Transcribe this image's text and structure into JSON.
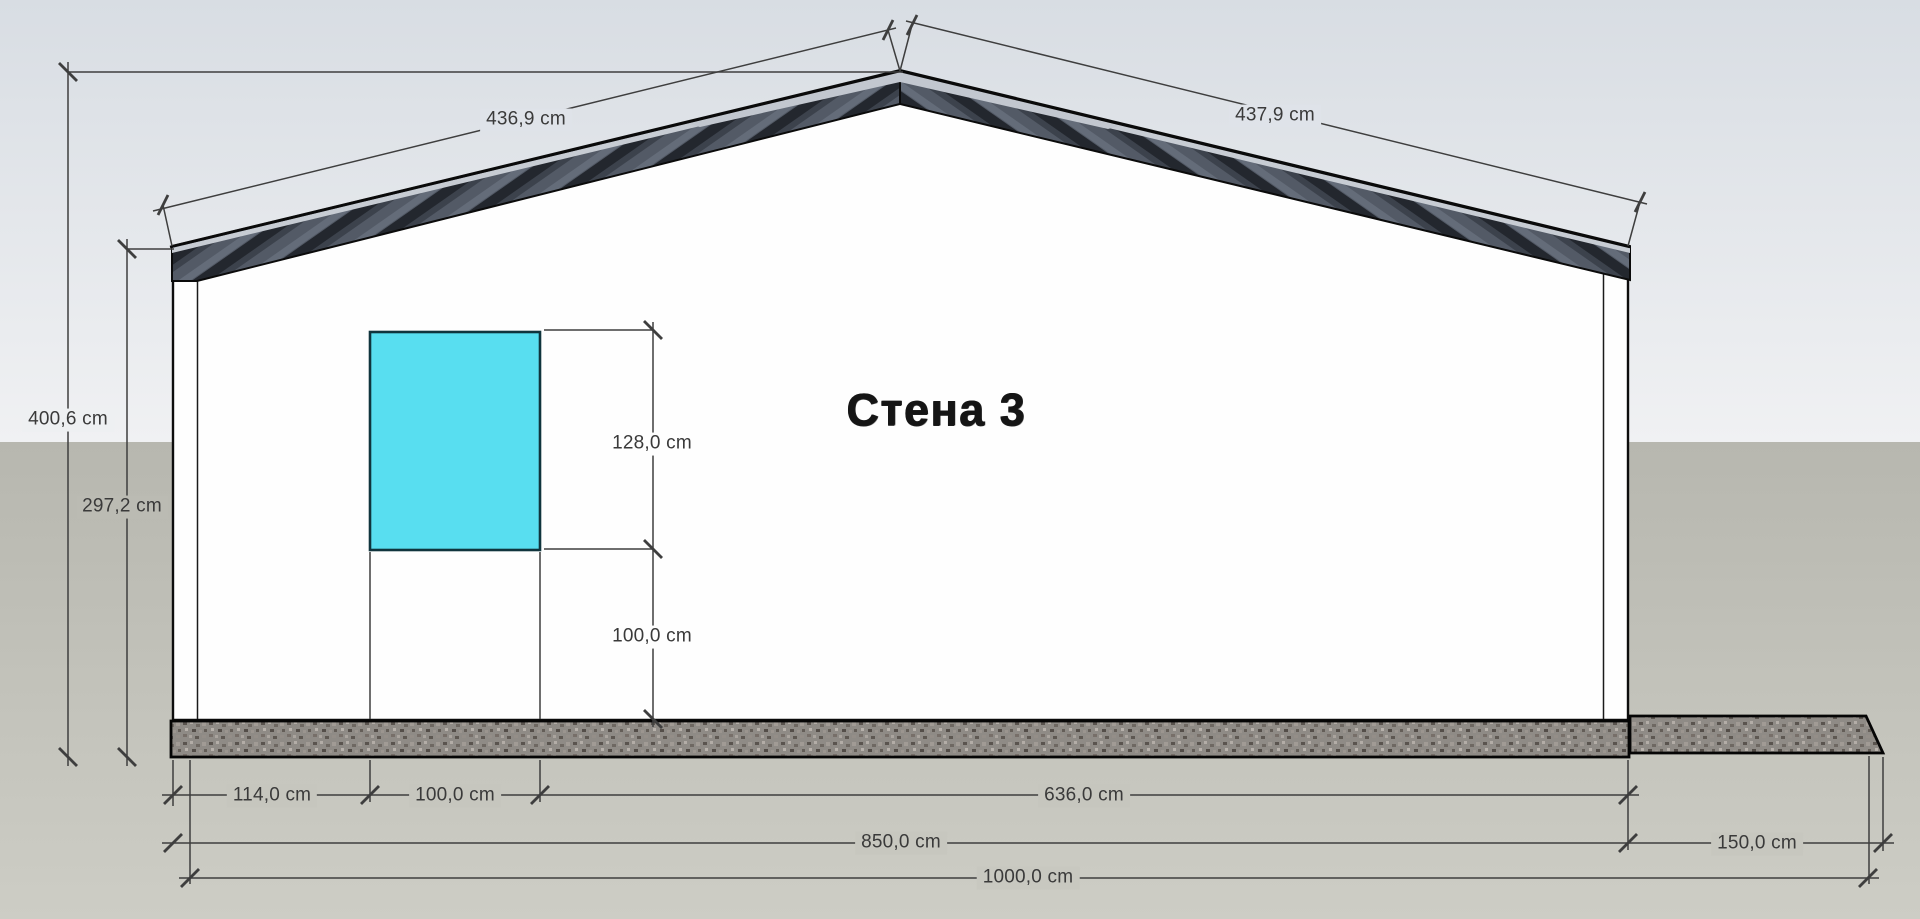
{
  "view": {
    "wall_label": "Стена 3",
    "unit": "cm"
  },
  "dims": {
    "roof_left": "436,9 cm",
    "roof_right": "437,9 cm",
    "total_height": "400,6 cm",
    "eave_height": "297,2 cm",
    "window_height": "128,0 cm",
    "window_sill": "100,0 cm",
    "window_left_offset": "114,0 cm",
    "window_width": "100,0 cm",
    "right_segment": "636,0 cm",
    "house_length": "850,0 cm",
    "porch_length": "150,0 cm",
    "total_length": "1000,0 cm"
  },
  "colors": {
    "window_fill": "#58DEF0",
    "roof_fascia": "#4D5460",
    "roof_stripe_dark": "#23272E",
    "wall_fill": "#FEFEFE",
    "slab_base": "#8F8B86",
    "sky_top": "#D8DDE3",
    "sky_bottom": "#F0F1F3",
    "ground_top": "#B7B7AF",
    "ground_bottom": "#CDCDC5",
    "dimension_ink": "#3E3E3E"
  }
}
